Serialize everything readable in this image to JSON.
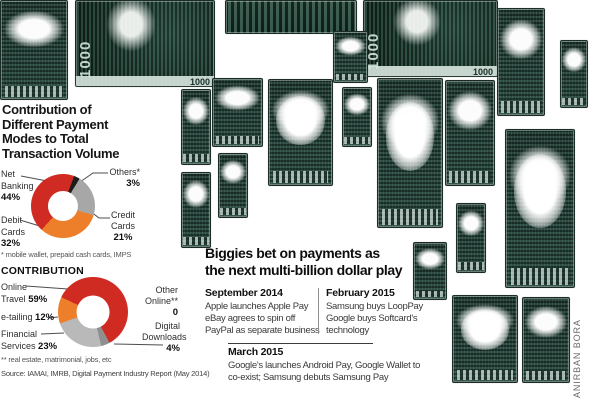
{
  "banknote": {
    "denomination": "1000"
  },
  "credit": "ANIRBAN BORA",
  "left_panel": {
    "title": {
      "line1": "Contribution of",
      "line2": "Different Payment",
      "line3": "Modes to Total",
      "line4": "Transaction Volume"
    },
    "footnote1": "* mobile wallet, prepaid cash cards, IMPS",
    "contribution_title": "CONTRIBUTION",
    "footnote2": "** real estate, matrimonial, jobs, etc",
    "source": "Source: IAMAI, IMRB, Digital Payment Industry Report (May 2014)"
  },
  "donut1_labels": {
    "net": {
      "l1": "Net",
      "l2": "Banking",
      "pct": "44%"
    },
    "debit": {
      "l1": "Debit",
      "l2": "Cards",
      "pct": "32%"
    },
    "others": {
      "l1": "Others*",
      "pct": "3%"
    },
    "credit": {
      "l1": "Credit",
      "l2": "Cards",
      "pct": "21%"
    }
  },
  "donut2_labels": {
    "online_travel": {
      "l1": "Online",
      "l2": "Travel",
      "pct": "59%"
    },
    "etailing": {
      "l1": "e-tailing",
      "pct": "12%"
    },
    "financial": {
      "l1": "Financial",
      "l2": "Services",
      "pct": "23%"
    },
    "other_online": {
      "l1": "Other",
      "l2": "Online**",
      "pct": "0"
    },
    "digital": {
      "l1": "Digital",
      "l2": "Downloads",
      "pct": "4%"
    }
  },
  "story": {
    "headline1": "Biggies bet on payments as",
    "headline2": "the next multi-billion dollar play",
    "col1": {
      "heading": "September 2014",
      "line1": "Apple launches Apple Pay",
      "line2": "eBay agrees to spin off",
      "line3": "PayPal as separate business"
    },
    "col2": {
      "heading": "February 2015",
      "line1": "Samsung buys LoopPay",
      "line2": "Google buys Softcard's",
      "line3": "technology"
    },
    "march": {
      "heading": "March 2015",
      "line1": "Google's launches Android Pay, Google Wallet to",
      "line2": "co-exist; Samsung debuts Samsung Pay"
    }
  },
  "chart_data": [
    {
      "type": "pie",
      "subtype": "donut",
      "title": "Contribution of Different Payment Modes to Total Transaction Volume",
      "legend_position": "callouts",
      "start_deg": 222,
      "segments": [
        {
          "label": "Net Banking",
          "value": 44,
          "color": "#d02b22"
        },
        {
          "label": "Others*",
          "value": 3,
          "color": "#1d1d1b"
        },
        {
          "label": "Credit Cards",
          "value": 21,
          "color": "#a7a7a7"
        },
        {
          "label": "Debit Cards",
          "value": 32,
          "color": "#ee7f2a"
        }
      ],
      "footnote": "* mobile wallet, prepaid cash cards, IMPS"
    },
    {
      "type": "pie",
      "subtype": "donut",
      "title": "CONTRIBUTION",
      "legend_position": "callouts",
      "start_deg": 295,
      "segments": [
        {
          "label": "Online Travel",
          "value": 59,
          "color": "#d02b22"
        },
        {
          "label": "Digital Downloads",
          "value": 4,
          "color": "#8f8f8f"
        },
        {
          "label": "Financial Services",
          "value": 23,
          "color": "#b9b9b9"
        },
        {
          "label": "e-tailing",
          "value": 12,
          "color": "#ee7f2a"
        },
        {
          "label": "Other Online**",
          "value": 0,
          "color": "#cccccc"
        }
      ],
      "footnote": "** real estate, matrimonial, jobs, etc",
      "source": "Source: IAMAI, IMRB, Digital Payment Industry Report (May 2014)"
    }
  ]
}
